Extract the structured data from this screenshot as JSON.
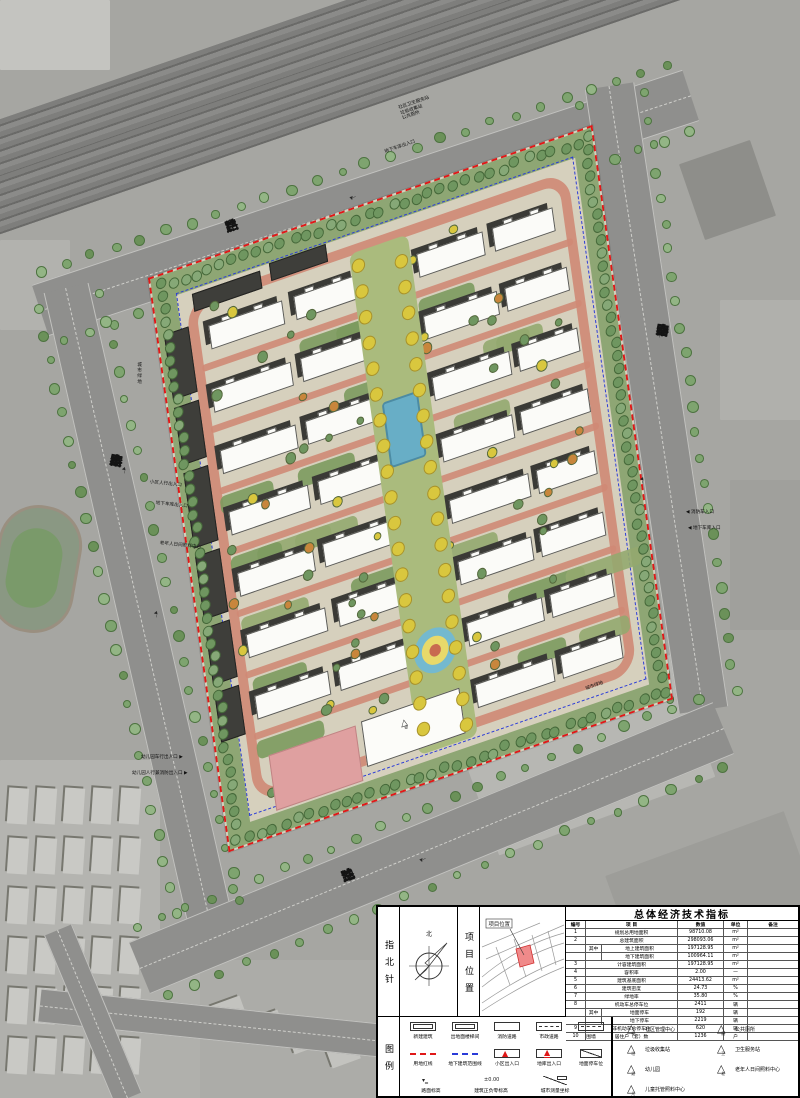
{
  "roads": {
    "top": "兰启路",
    "right": "秦宫四路",
    "left": "秦宫三路",
    "bottom": "兰池二路"
  },
  "site_marks": {
    "kindergarten_char": "幼"
  },
  "annotations": [
    {
      "lines": [
        "社区卫生服务站",
        "垃圾收集站",
        "公共厕所"
      ]
    },
    {
      "text": "地下车库出入口"
    },
    {
      "text": "消防车入口"
    },
    {
      "text": "地下车库入口"
    },
    {
      "text": "小区人行出入口"
    },
    {
      "text": "地下车库出入口"
    },
    {
      "text": "老年人日间照料中心"
    },
    {
      "text": "幼儿园车行出入口"
    },
    {
      "text": "幼儿园人行兼消防出入口"
    },
    {
      "text": "城市绿地"
    },
    {
      "text": "城市绿地"
    }
  ],
  "title_block": {
    "north_label": "指北针",
    "north_char": "北",
    "location_label": "项目位置",
    "location_tag": "项目位置",
    "legend_label": "图例",
    "table": {
      "title": "总体经济技术指标",
      "headers": [
        "编号",
        "项 目",
        "数值",
        "单位",
        "备注"
      ],
      "rows": [
        {
          "no": "1",
          "item": "规划总用地面积",
          "value": "98710.08",
          "unit": "m²",
          "note": ""
        },
        {
          "no": "2",
          "item": "总建筑面积",
          "value": "298093.06",
          "unit": "m²",
          "note": ""
        },
        {
          "no": "",
          "qz": "其中",
          "item": "地上建筑面积",
          "value": "197128.95",
          "unit": "m²",
          "note": ""
        },
        {
          "no": "",
          "qz": "",
          "item": "地下建筑面积",
          "value": "100964.11",
          "unit": "m²",
          "note": ""
        },
        {
          "no": "3",
          "item": "计容建筑面积",
          "value": "197128.95",
          "unit": "m²",
          "note": ""
        },
        {
          "no": "4",
          "item": "容积率",
          "value": "2.00",
          "unit": "—",
          "note": ""
        },
        {
          "no": "5",
          "item": "建筑基底面积",
          "value": "24413.62",
          "unit": "m²",
          "note": ""
        },
        {
          "no": "6",
          "item": "建筑密度",
          "value": "24.73",
          "unit": "%",
          "note": ""
        },
        {
          "no": "7",
          "item": "绿地率",
          "value": "35.80",
          "unit": "%",
          "note": ""
        },
        {
          "no": "8",
          "item": "机动车总停车位",
          "value": "2411",
          "unit": "辆",
          "note": ""
        },
        {
          "no": "",
          "qz": "其中",
          "item": "地面停车",
          "value": "192",
          "unit": "辆",
          "note": ""
        },
        {
          "no": "",
          "qz": "",
          "item": "地下停车",
          "value": "2219",
          "unit": "辆",
          "note": ""
        },
        {
          "no": "9",
          "item": "非机动车总停车位",
          "value": "620",
          "unit": "辆",
          "note": ""
        },
        {
          "no": "10",
          "item": "居住户（套）数",
          "value": "1236",
          "unit": "户",
          "note": ""
        }
      ]
    },
    "legend": {
      "grid": [
        {
          "symbol": "new-building",
          "label": "新建建筑"
        },
        {
          "symbol": "stair-exit",
          "label": "出地面楼梯间"
        },
        {
          "symbol": "fire-road",
          "label": "消防道路"
        },
        {
          "symbol": "municipal-road",
          "label": "市政道路"
        },
        {
          "symbol": "fence",
          "label": "围墙"
        },
        {
          "symbol": "red-line",
          "label": "用地红线"
        },
        {
          "symbol": "underground-line",
          "label": "地下建筑范围线"
        },
        {
          "symbol": "community-entrance",
          "label": "小区出入口"
        },
        {
          "symbol": "garage-entrance",
          "label": "地库出入口"
        },
        {
          "symbol": "surface-parking",
          "label": "地面停车位"
        },
        {
          "symbol": "road-elevation",
          "label": "路面标高"
        },
        {
          "symbol": "zero-elevation",
          "label": "建筑正负零标高"
        },
        {
          "symbol": "survey-coord",
          "label": "城市测量坐标"
        }
      ],
      "facilities": [
        {
          "char": "社",
          "label": "社区管理中心"
        },
        {
          "char": "厕",
          "label": "公共厕所"
        },
        {
          "char": "垃",
          "label": "垃圾收集站"
        },
        {
          "char": "卫",
          "label": "卫生服务站"
        },
        {
          "char": "幼",
          "label": "幼儿园"
        },
        {
          "char": "老",
          "label": "老年人日间照料中心"
        },
        {
          "char": "儿",
          "label": "儿童托管照料中心"
        }
      ]
    }
  }
}
